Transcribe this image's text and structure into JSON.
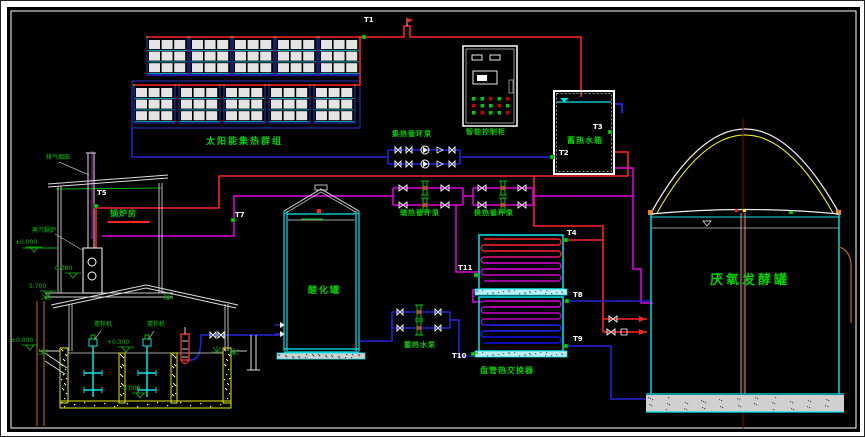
{
  "drawing": {
    "equipment": {
      "solar_array": "太阳能集热群组",
      "collector_pump": "集热循环泵",
      "control_cabinet": "智能控制柜",
      "storage_tank": "蓄热水箱",
      "aux_heat_pump": "辅热循环泵",
      "heat_exchange_pump": "换热循环泵",
      "storage_water_pump": "蓄热水泵",
      "boiler_room": "锅炉房",
      "exhaust_chimney": "排气烟囱",
      "steam_boiler": "蒸汽锅炉",
      "acidification_tank": "酸化罐",
      "coil_heat_exchanger": "盘管热交换器",
      "anaerobic_digester": "厌氧发酵罐",
      "mixer_1": "搅拌机",
      "mixer_2": "搅拌机"
    },
    "sensor_tags": {
      "t1": "T1",
      "t2": "T2",
      "t3": "T3",
      "t4": "T4",
      "t5": "T5",
      "t7": "T7",
      "t8": "T8",
      "t9": "T9",
      "t10": "T10",
      "t11": "T11"
    },
    "elevations": {
      "pool_roof": "5.700",
      "pool_ground": "±0.000",
      "pool_rim": "+0.300",
      "pool_bottom": "-3.000",
      "boiler_floor": "0.280",
      "boiler_ground": "±0.000"
    },
    "colors": {
      "hot_supply": "#ff2222",
      "cold_return": "#2222dd",
      "heat_medium": "#dd00dd",
      "water_cyan": "#00e5ee",
      "label_green": "#00d000",
      "wall_yellow": "#e8e800",
      "structure_white": "#ffffff"
    }
  }
}
